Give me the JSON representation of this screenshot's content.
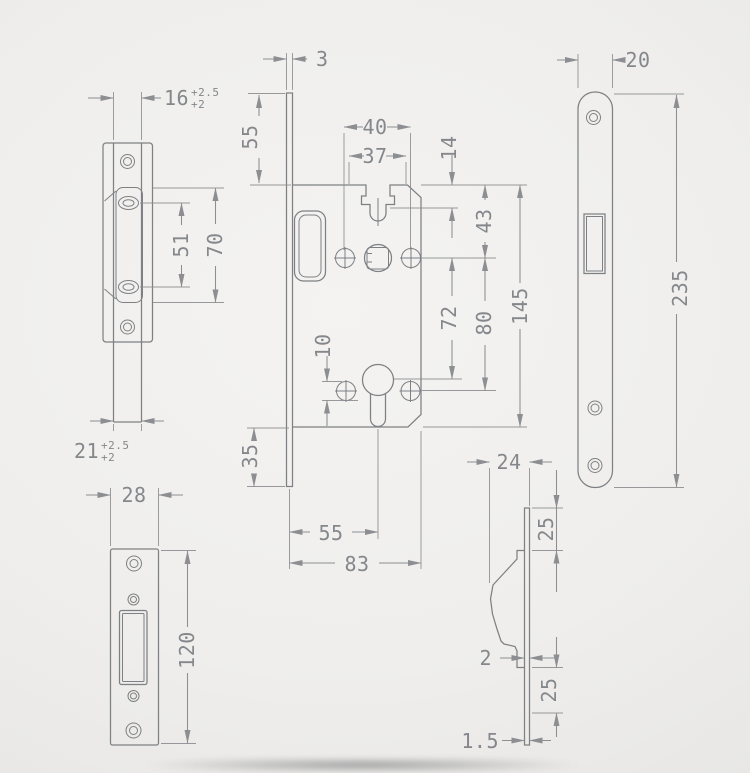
{
  "page": {
    "title": "Mortise lock technical drawing",
    "background": "#eeedeb",
    "line_color": "#7d8084",
    "dim_line_color": "#8c8e91",
    "text_color": "#84878b"
  },
  "views": {
    "strike_box_front": {
      "name": "strike box front view",
      "dims": [
        "16 +2.5/+2",
        "51",
        "70",
        "21 +2.5/+2"
      ]
    },
    "lock_case_front": {
      "name": "lock case front view",
      "dims": [
        "3",
        "55",
        "40",
        "37",
        "14",
        "43",
        "72",
        "80",
        "145",
        "10",
        "35",
        "55",
        "83"
      ]
    },
    "long_faceplate_front": {
      "name": "faceplate front view",
      "dims": [
        "20",
        "235"
      ]
    },
    "strike_plate_front": {
      "name": "strike plate front view",
      "dims": [
        "28",
        "120"
      ]
    },
    "side_profile": {
      "name": "side profile view",
      "dims": [
        "24",
        "25",
        "2",
        "25",
        "1.5"
      ]
    }
  },
  "dimensions": [
    {
      "id": "dim-3",
      "view": "lock_case_front",
      "text": "3",
      "x": 316,
      "y": 66,
      "rotate": false,
      "anchor": "start"
    },
    {
      "id": "dim-55-top",
      "view": "lock_case_front",
      "text": "55",
      "x": 257,
      "y": 137,
      "rotate": true,
      "anchor": "middle"
    },
    {
      "id": "dim-40",
      "view": "lock_case_front",
      "text": "40",
      "x": 375,
      "y": 134,
      "rotate": false,
      "anchor": "middle"
    },
    {
      "id": "dim-37",
      "view": "lock_case_front",
      "text": "37",
      "x": 375,
      "y": 163,
      "rotate": false,
      "anchor": "middle"
    },
    {
      "id": "dim-14",
      "view": "lock_case_front",
      "text": "14",
      "x": 456,
      "y": 148,
      "rotate": true,
      "anchor": "middle"
    },
    {
      "id": "dim-43",
      "view": "lock_case_front",
      "text": "43",
      "x": 491,
      "y": 221,
      "rotate": true,
      "anchor": "middle"
    },
    {
      "id": "dim-72",
      "view": "lock_case_front",
      "text": "72",
      "x": 456,
      "y": 318,
      "rotate": true,
      "anchor": "middle"
    },
    {
      "id": "dim-80",
      "view": "lock_case_front",
      "text": "80",
      "x": 491,
      "y": 323,
      "rotate": true,
      "anchor": "middle"
    },
    {
      "id": "dim-145",
      "view": "lock_case_front",
      "text": "145",
      "x": 527,
      "y": 306,
      "rotate": true,
      "anchor": "middle"
    },
    {
      "id": "dim-10",
      "view": "lock_case_front",
      "text": "10",
      "x": 330,
      "y": 346,
      "rotate": true,
      "anchor": "middle"
    },
    {
      "id": "dim-35",
      "view": "lock_case_front",
      "text": "35",
      "x": 257,
      "y": 456,
      "rotate": true,
      "anchor": "middle"
    },
    {
      "id": "dim-55-bottom",
      "view": "lock_case_front",
      "text": "55",
      "x": 331,
      "y": 540,
      "rotate": false,
      "anchor": "middle"
    },
    {
      "id": "dim-83",
      "view": "lock_case_front",
      "text": "83",
      "x": 357,
      "y": 571,
      "rotate": false,
      "anchor": "middle"
    },
    {
      "id": "dim-16-tol",
      "view": "strike_box_front",
      "text": "16",
      "sup": "+2.5",
      "sub": "+2",
      "x": 164,
      "y": 105,
      "rotate": false,
      "anchor": "start"
    },
    {
      "id": "dim-51",
      "view": "strike_box_front",
      "text": "51",
      "x": 188,
      "y": 245,
      "rotate": true,
      "anchor": "middle"
    },
    {
      "id": "dim-70",
      "view": "strike_box_front",
      "text": "70",
      "x": 222,
      "y": 245,
      "rotate": true,
      "anchor": "middle"
    },
    {
      "id": "dim-21-tol",
      "view": "strike_box_front",
      "text": "21",
      "sup": "+2.5",
      "sub": "+2",
      "x": 74,
      "y": 458,
      "rotate": false,
      "anchor": "start"
    },
    {
      "id": "dim-28",
      "view": "strike_plate_front",
      "text": "28",
      "x": 134,
      "y": 502,
      "rotate": false,
      "anchor": "middle"
    },
    {
      "id": "dim-120",
      "view": "strike_plate_front",
      "text": "120",
      "x": 194,
      "y": 650,
      "rotate": true,
      "anchor": "middle"
    },
    {
      "id": "dim-20",
      "view": "long_faceplate_front",
      "text": "20",
      "x": 638,
      "y": 67,
      "rotate": false,
      "anchor": "middle"
    },
    {
      "id": "dim-235",
      "view": "long_faceplate_front",
      "text": "235",
      "x": 687,
      "y": 288,
      "rotate": true,
      "anchor": "middle"
    },
    {
      "id": "dim-24",
      "view": "side_profile",
      "text": "24",
      "x": 509,
      "y": 469,
      "rotate": false,
      "anchor": "middle"
    },
    {
      "id": "dim-25-upper",
      "view": "side_profile",
      "text": "25",
      "x": 553,
      "y": 529,
      "rotate": true,
      "anchor": "middle"
    },
    {
      "id": "dim-2",
      "view": "side_profile",
      "text": "2",
      "x": 492,
      "y": 665,
      "rotate": false,
      "anchor": "end"
    },
    {
      "id": "dim-25-lower",
      "view": "side_profile",
      "text": "25",
      "x": 556,
      "y": 690,
      "rotate": true,
      "anchor": "middle"
    },
    {
      "id": "dim-1p5",
      "view": "side_profile",
      "text": "1.5",
      "x": 499,
      "y": 748,
      "rotate": false,
      "anchor": "end"
    }
  ]
}
